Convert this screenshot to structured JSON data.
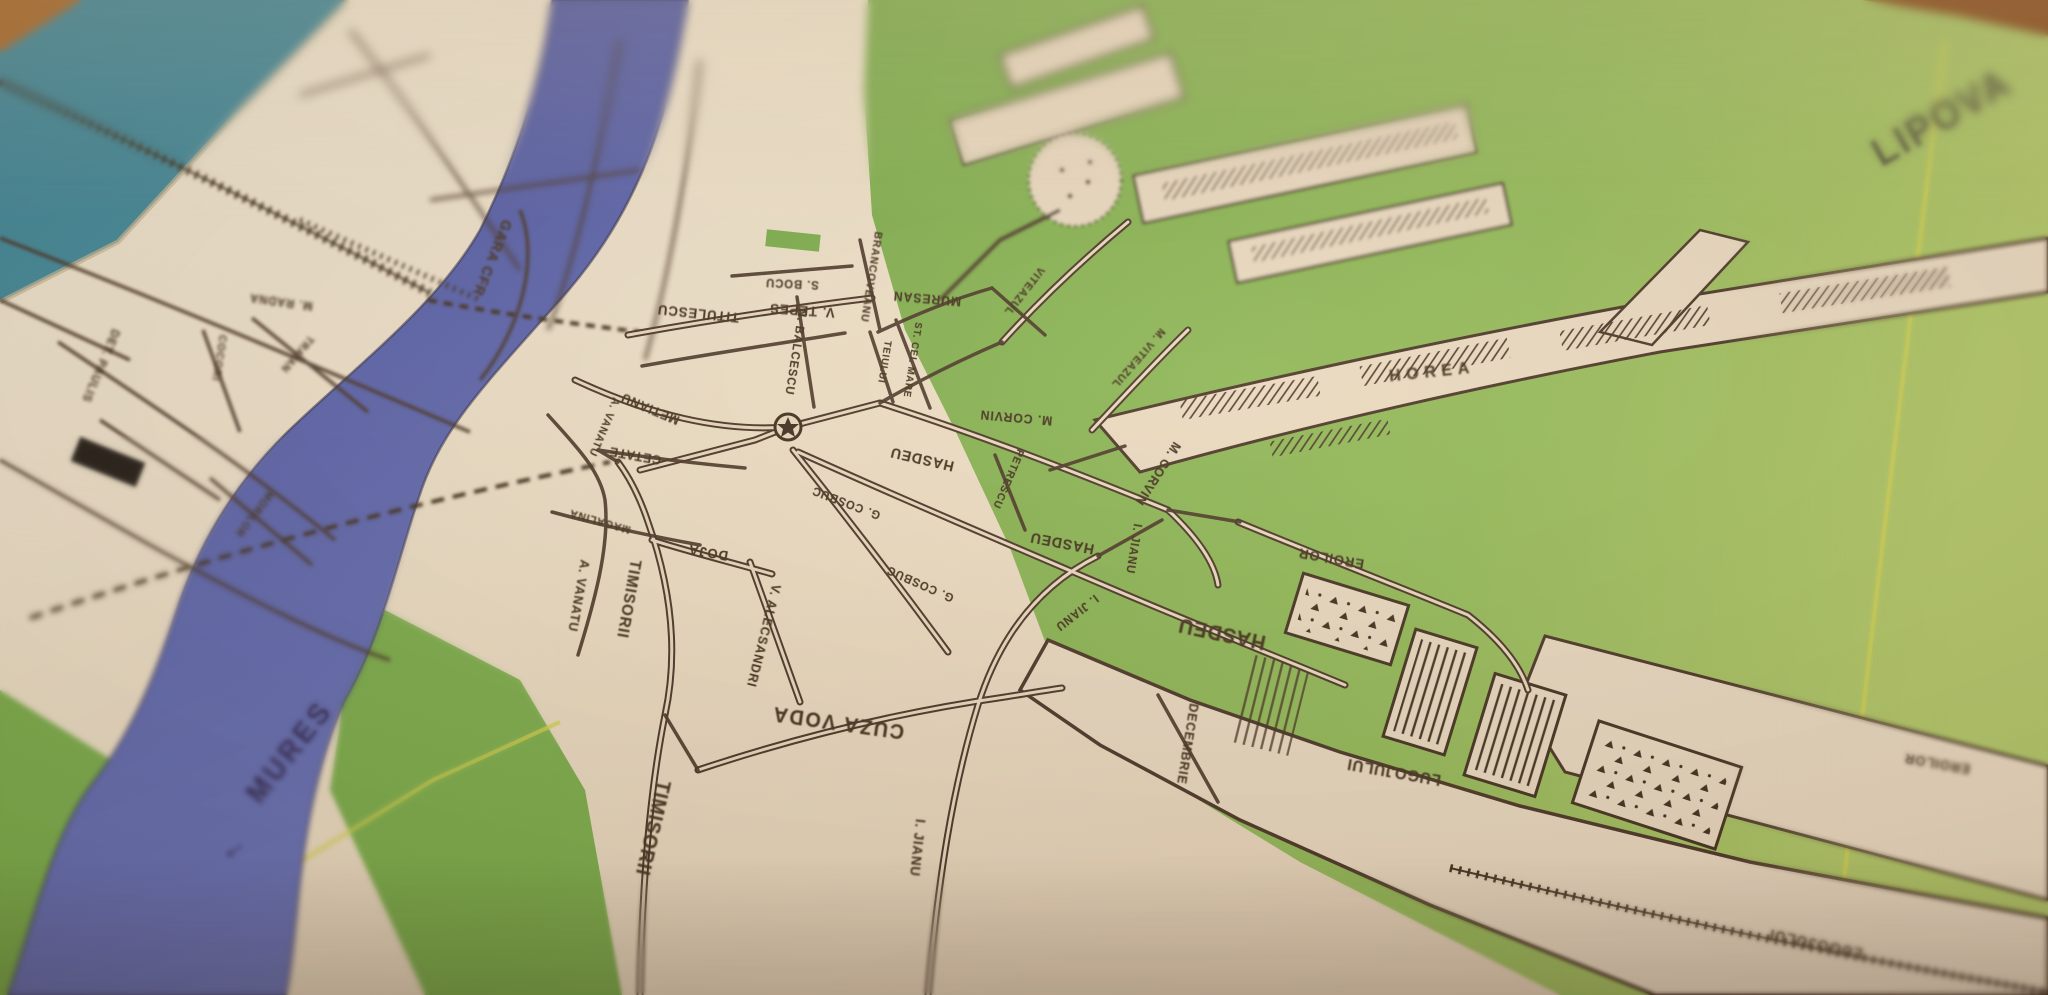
{
  "photo": {
    "subject": "printed town street map photographed at an angle on a wooden table",
    "town": "LIPOVA",
    "river": "MURES"
  },
  "palette": {
    "paper": "#eddcc2",
    "ink": "#4a3526",
    "river_blue": "#5560ab",
    "green": "#85b354",
    "green_light": "#a9c465",
    "teal_edge": "#42899b",
    "wood": "#a96a2c",
    "road_yellow": "#d6d24f",
    "river_label_ink": "#332a56"
  },
  "map": {
    "region_label": "LIPOVA",
    "river": {
      "name": "MURES",
      "flow_arrow": "←"
    },
    "poi": [
      {
        "name": "town-center-star-marker",
        "symbol": "star-in-circle"
      }
    ],
    "labels": [
      {
        "name": "region-label-lipova",
        "text": "LIPOVA",
        "x": 1942,
        "y": 118,
        "rot": -30,
        "size": 40,
        "weight": 700,
        "ls": 3,
        "color": "#55523a",
        "blur": 1.2
      },
      {
        "name": "river-label-mures",
        "text": "MURES",
        "x": 290,
        "y": 752,
        "rot": -52,
        "size": 30,
        "weight": 700,
        "ls": 4,
        "color": "#332a56",
        "blur": 0.6
      },
      {
        "name": "river-flow-arrow",
        "text": "←",
        "x": 232,
        "y": 846,
        "rot": -35,
        "size": 32,
        "weight": 400,
        "color": "#332a56",
        "blur": 0.6
      },
      {
        "name": "street-label-gara-cfr",
        "text": "GARA CFR",
        "x": 492,
        "y": 258,
        "rot": 112,
        "size": 15,
        "blur": 1.4
      },
      {
        "name": "street-label-titulescu",
        "text": "TITULESCU",
        "x": 698,
        "y": 314,
        "rot": 186,
        "size": 14,
        "blur": 0.4
      },
      {
        "name": "street-label-v-tepes",
        "text": "V. TEPES",
        "x": 802,
        "y": 311,
        "rot": 184,
        "size": 14,
        "blur": 0.4
      },
      {
        "name": "street-label-s-bocu",
        "text": "S. BOCU",
        "x": 792,
        "y": 284,
        "rot": 183,
        "size": 12,
        "blur": 0.5
      },
      {
        "name": "street-label-n-balcescu",
        "text": "N. BALCESCU",
        "x": 796,
        "y": 352,
        "rot": 99,
        "size": 12,
        "blur": 0.3
      },
      {
        "name": "street-label-brancoveanu",
        "text": "BRANCOVEANU",
        "x": 871,
        "y": 277,
        "rot": 99,
        "size": 11,
        "blur": 0.5
      },
      {
        "name": "street-label-muresan",
        "text": "MURESAN",
        "x": 927,
        "y": 299,
        "rot": 185,
        "size": 13,
        "blur": 0.4
      },
      {
        "name": "street-label-teiului",
        "text": "TEIULUI",
        "x": 884,
        "y": 362,
        "rot": 99,
        "size": 10,
        "blur": 0.3
      },
      {
        "name": "street-label-st-cel-mare",
        "text": "ST. CEL MARE",
        "x": 912,
        "y": 360,
        "rot": 99,
        "size": 10,
        "blur": 0.3
      },
      {
        "name": "street-label-viteazul",
        "text": "VITEAZUL",
        "x": 1024,
        "y": 291,
        "rot": 128,
        "size": 11,
        "blur": 0.5
      },
      {
        "name": "street-label-m-viteazul",
        "text": "M. VITEAZUL",
        "x": 1138,
        "y": 358,
        "rot": 131,
        "size": 11,
        "blur": 0.5
      },
      {
        "name": "street-label-horea",
        "text": "HOREA",
        "x": 1432,
        "y": 372,
        "rot": -6,
        "size": 17,
        "ls": 6,
        "weight": 700,
        "blur": 0.8
      },
      {
        "name": "street-label-m-corvin-1",
        "text": "M. CORVIN",
        "x": 1016,
        "y": 418,
        "rot": 185,
        "size": 13,
        "blur": 0.2
      },
      {
        "name": "street-label-m-corvin-2",
        "text": "M. CORVIN",
        "x": 1158,
        "y": 474,
        "rot": 123,
        "size": 13,
        "blur": 0.3
      },
      {
        "name": "street-label-hasdeu-1",
        "text": "HASDEU",
        "x": 922,
        "y": 459,
        "rot": 193,
        "size": 15,
        "blur": 0.2
      },
      {
        "name": "street-label-hasdeu-2",
        "text": "HASDEU",
        "x": 1062,
        "y": 543,
        "rot": 191,
        "size": 15,
        "blur": 0.2
      },
      {
        "name": "street-label-hasdeu-3",
        "text": "HASDEU",
        "x": 1222,
        "y": 633,
        "rot": 192,
        "size": 21,
        "weight": 700,
        "blur": 0.5
      },
      {
        "name": "street-label-petrescu",
        "text": "PETRESCU",
        "x": 1008,
        "y": 479,
        "rot": 113,
        "size": 11,
        "blur": 0.2
      },
      {
        "name": "street-label-i-jianu-1",
        "text": "I. JIANU",
        "x": 1134,
        "y": 549,
        "rot": 99,
        "size": 12,
        "blur": 0.3
      },
      {
        "name": "street-label-i-jianu-2",
        "text": "I. JIANU",
        "x": 1077,
        "y": 613,
        "rot": 142,
        "size": 12,
        "blur": 0.3
      },
      {
        "name": "street-label-i-jianu-3",
        "text": "I. JIANU",
        "x": 918,
        "y": 848,
        "rot": 96,
        "size": 14,
        "weight": 700,
        "blur": 0.8
      },
      {
        "name": "street-label-g-cosbuc-1",
        "text": "G. COSBUC",
        "x": 846,
        "y": 503,
        "rot": 201,
        "size": 12,
        "blur": 0.2
      },
      {
        "name": "street-label-g-cosbuc-2",
        "text": "G. COSBUC",
        "x": 920,
        "y": 584,
        "rot": 204,
        "size": 12,
        "blur": 0.3
      },
      {
        "name": "street-label-cuza-voda",
        "text": "CUZA VODA",
        "x": 838,
        "y": 722,
        "rot": 188,
        "size": 21,
        "weight": 700,
        "ls": 2,
        "blur": 0.5
      },
      {
        "name": "street-label-timisorii-1",
        "text": "TIMISORII",
        "x": 652,
        "y": 828,
        "rot": 103,
        "size": 20,
        "weight": 700,
        "blur": 0.8
      },
      {
        "name": "street-label-timisorii-2",
        "text": "TIMISORII",
        "x": 628,
        "y": 599,
        "rot": 100,
        "size": 16,
        "weight": 700,
        "blur": 0.5
      },
      {
        "name": "street-label-a-vanatu-1",
        "text": "A. VANATU",
        "x": 604,
        "y": 427,
        "rot": 113,
        "size": 11,
        "blur": 0.4
      },
      {
        "name": "street-label-a-vanatu-2",
        "text": "A. VANATU",
        "x": 579,
        "y": 596,
        "rot": 100,
        "size": 13,
        "blur": 0.5
      },
      {
        "name": "street-label-metianu",
        "text": "METIANU",
        "x": 650,
        "y": 409,
        "rot": 203,
        "size": 13,
        "blur": 0.4
      },
      {
        "name": "street-label-cetate",
        "text": "CETATE",
        "x": 635,
        "y": 456,
        "rot": 190,
        "size": 13,
        "blur": 0.4
      },
      {
        "name": "street-label-magalina",
        "text": "MAGALINA",
        "x": 600,
        "y": 521,
        "rot": 196,
        "size": 11,
        "blur": 0.5
      },
      {
        "name": "street-label-doja",
        "text": "DOJA",
        "x": 708,
        "y": 553,
        "rot": 190,
        "size": 14,
        "blur": 0.3
      },
      {
        "name": "street-label-v-alecsandri",
        "text": "V. ALECSANDRI",
        "x": 764,
        "y": 636,
        "rot": 104,
        "size": 13,
        "blur": 0.4
      },
      {
        "name": "street-label-decembrie",
        "text": "DECEMBRIE",
        "x": 1188,
        "y": 744,
        "rot": 99,
        "size": 13,
        "blur": 0.5
      },
      {
        "name": "street-label-lugojului-1",
        "text": "LUGOJULUI",
        "x": 1394,
        "y": 771,
        "rot": 190,
        "size": 16,
        "blur": 0.6
      },
      {
        "name": "street-label-lugojului-2",
        "text": "LUGOJULUI",
        "x": 1816,
        "y": 943,
        "rot": 192,
        "size": 16,
        "blur": 0.9
      },
      {
        "name": "street-label-eroilor-1",
        "text": "EROILOR",
        "x": 1331,
        "y": 559,
        "rot": 190,
        "size": 14,
        "blur": 0.4
      },
      {
        "name": "street-label-eroilor-2",
        "text": "EROILOR",
        "x": 1937,
        "y": 764,
        "rot": 190,
        "size": 14,
        "blur": 0.9
      },
      {
        "name": "street-label-det-paulis",
        "text": "DET. PAULIS",
        "x": 101,
        "y": 366,
        "rot": 113,
        "size": 12,
        "blur": 1.6
      },
      {
        "name": "street-label-m-radna",
        "text": "M. RADNA",
        "x": 281,
        "y": 302,
        "rot": 188,
        "size": 12,
        "blur": 1.6
      },
      {
        "name": "street-label-cocori",
        "text": "COCORI",
        "x": 219,
        "y": 358,
        "rot": 99,
        "size": 11,
        "blur": 1.6
      },
      {
        "name": "street-label-traian",
        "text": "TRAIAN",
        "x": 297,
        "y": 354,
        "rot": 130,
        "size": 11,
        "blur": 1.6
      },
      {
        "name": "street-label-morilor",
        "text": "MORILOR",
        "x": 254,
        "y": 514,
        "rot": 128,
        "size": 11,
        "blur": 1.5
      }
    ]
  }
}
